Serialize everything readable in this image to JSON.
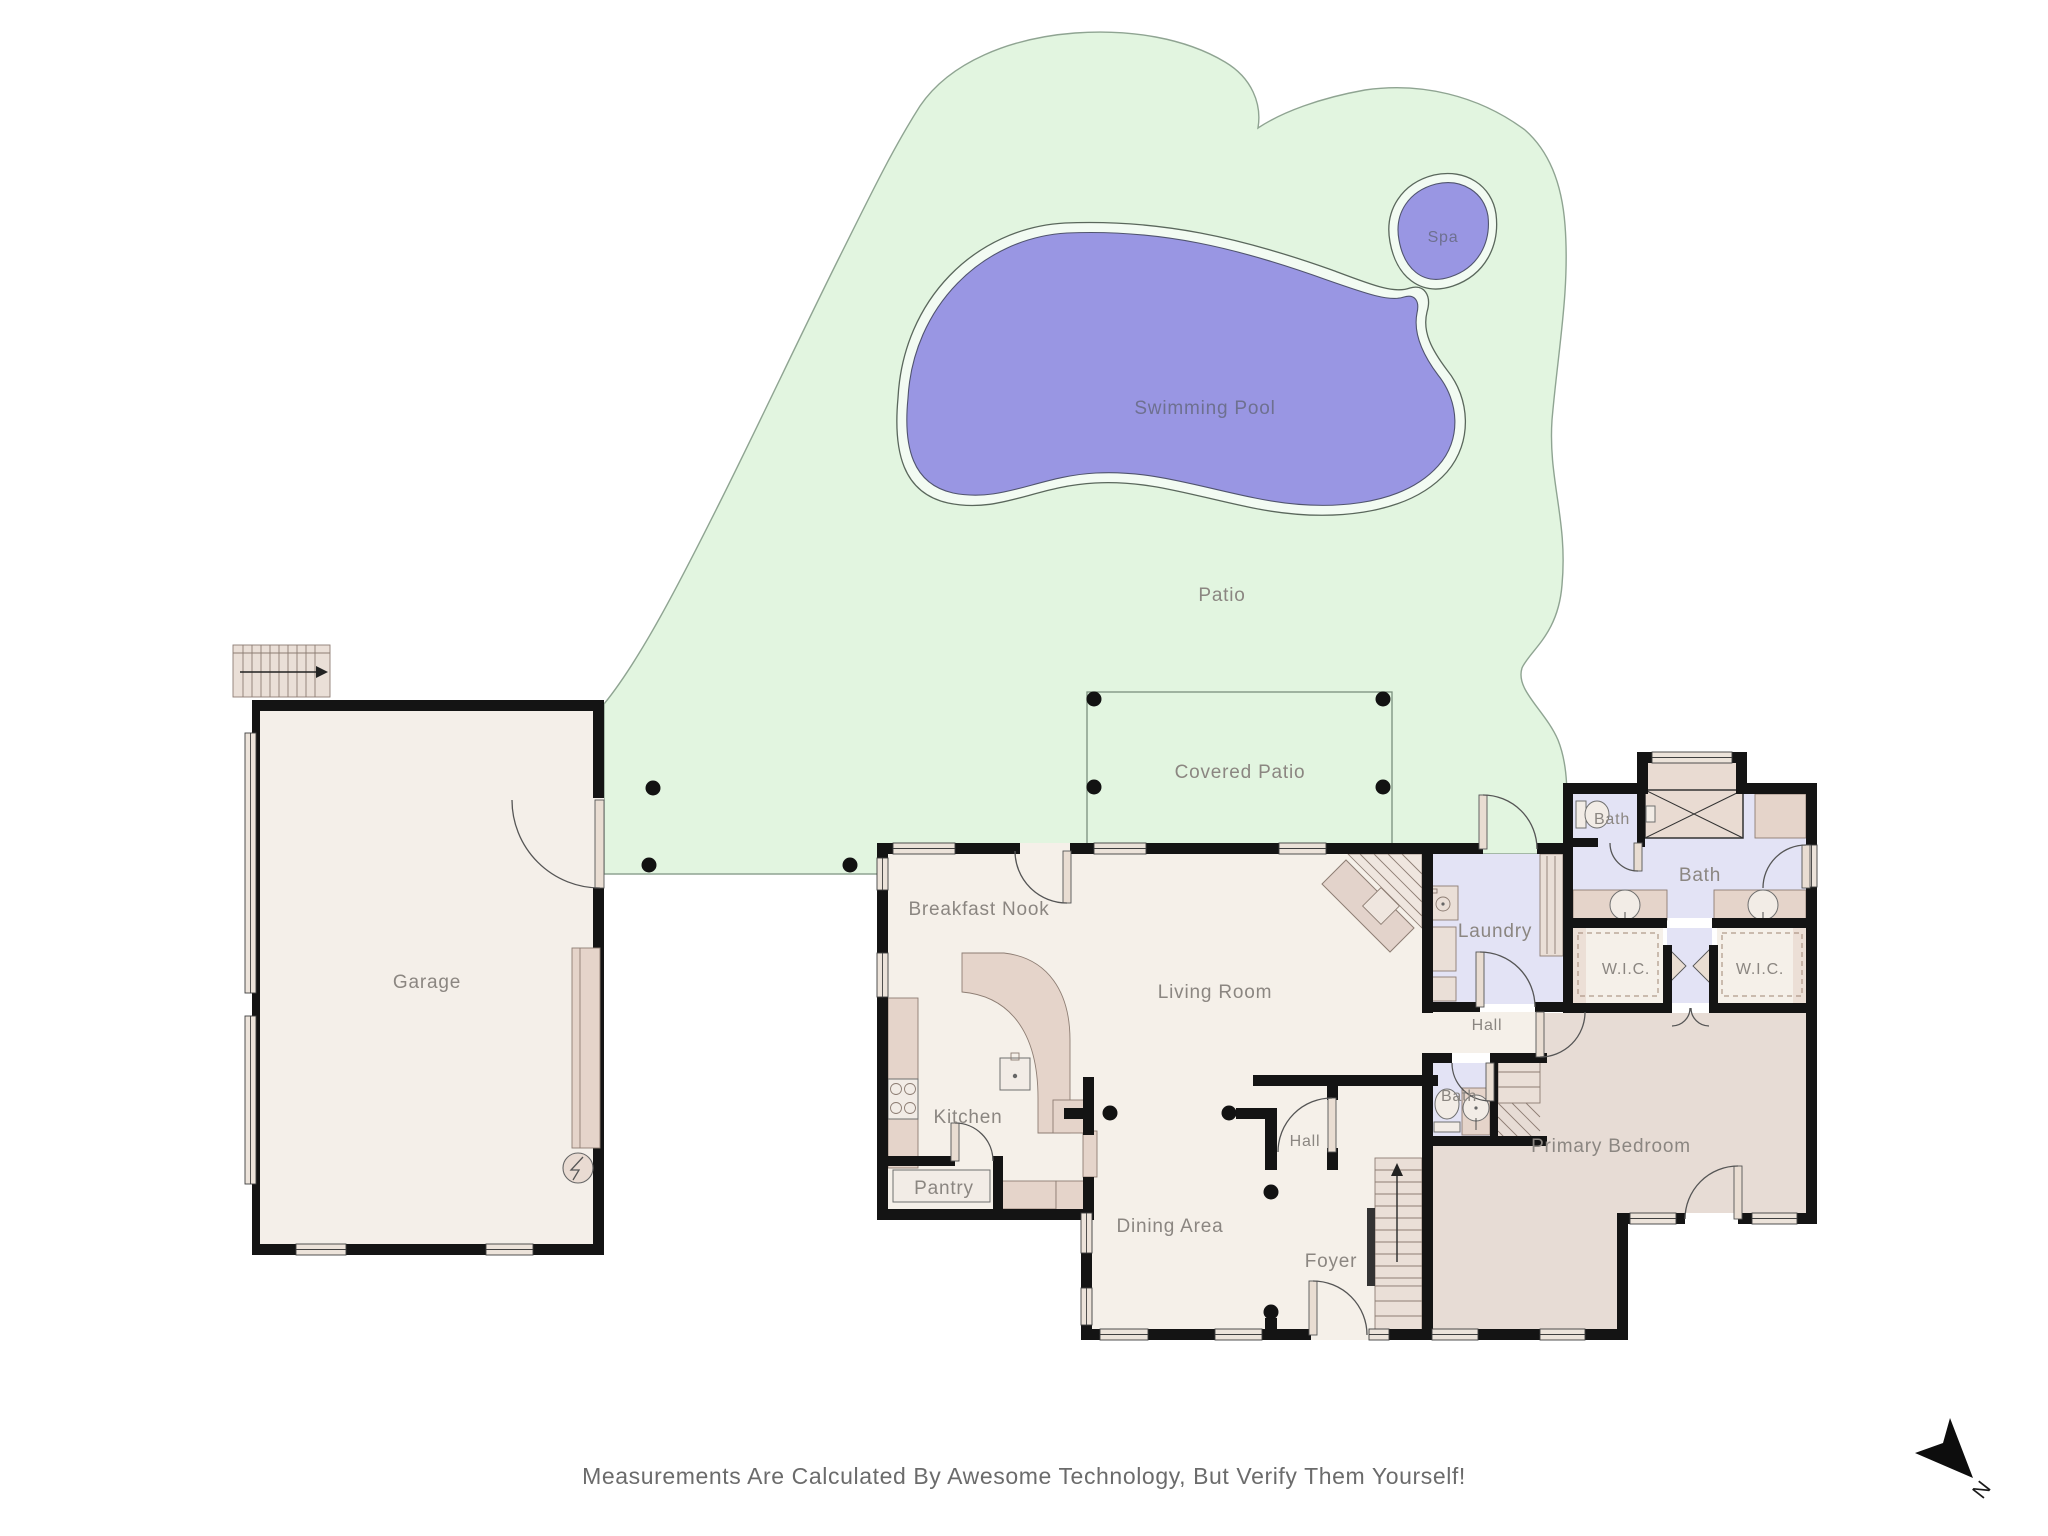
{
  "colors": {
    "yard": "#e2f5e0",
    "yard_outline": "#8fa492",
    "pool": "#9996e3",
    "pool_coping": "#f2fbf2",
    "house_floor": "#f5f0e9",
    "bath_floor": "#e3e3f5",
    "bedroom_floor": "#e7dcd5",
    "wall": "#141414",
    "furniture": "#e5d4ca",
    "label_text": "#8b8681"
  },
  "labels": {
    "spa": "Spa",
    "swimming_pool": "Swimming Pool",
    "patio": "Patio",
    "covered_patio": "Covered Patio",
    "garage": "Garage",
    "breakfast_nook": "Breakfast Nook",
    "living_room": "Living Room",
    "kitchen": "Kitchen",
    "pantry": "Pantry",
    "dining_area": "Dining Area",
    "foyer": "Foyer",
    "hall_center": "Hall",
    "hall_right": "Hall",
    "laundry": "Laundry",
    "bath_upper": "Bath",
    "bath_main": "Bath",
    "bath_primary": "Bath",
    "wic_left": "W.I.C.",
    "wic_right": "W.I.C.",
    "primary_bedroom": "Primary Bedroom"
  },
  "note": {
    "disclaimer": "Measurements Are Calculated By Awesome Technology, But Verify Them Yourself!"
  },
  "compass": {
    "label": "N"
  }
}
